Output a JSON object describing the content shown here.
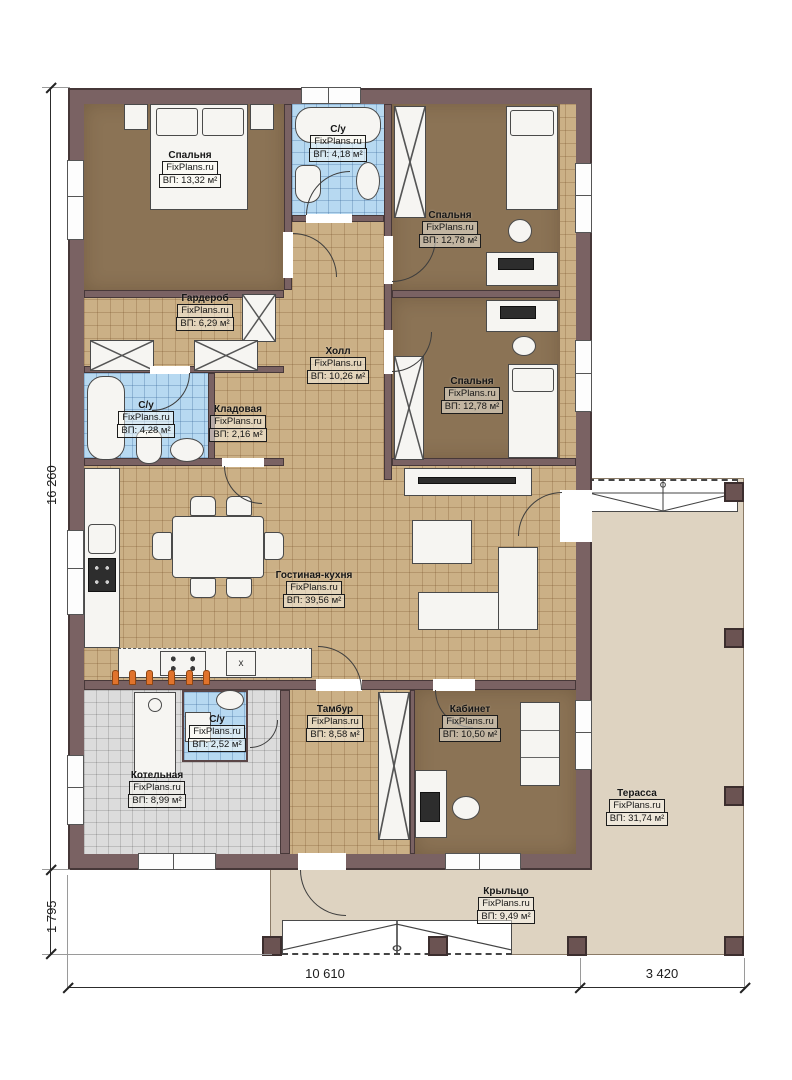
{
  "brand": "FixPlans.ru",
  "rooms": {
    "bedroom1": {
      "name": "Спальня",
      "area": "ВП: 13,32 м²"
    },
    "bath1": {
      "name": "С/у",
      "area": "ВП: 4,18 м²"
    },
    "bedroom2": {
      "name": "Спальня",
      "area": "ВП: 12,78 м²"
    },
    "wardrobe": {
      "name": "Гардероб",
      "area": "ВП: 6,29 м²"
    },
    "hall": {
      "name": "Холл",
      "area": "ВП: 10,26 м²"
    },
    "bedroom3": {
      "name": "Спальня",
      "area": "ВП: 12,78 м²"
    },
    "bath2": {
      "name": "С/у",
      "area": "ВП: 4,28 м²"
    },
    "storage": {
      "name": "Кладовая",
      "area": "ВП: 2,16 м²"
    },
    "living": {
      "name": "Гостиная-кухня",
      "area": "ВП: 39,56 м²"
    },
    "vestibule": {
      "name": "Тамбур",
      "area": "ВП: 8,58 м²"
    },
    "office": {
      "name": "Кабинет",
      "area": "ВП: 10,50 м²"
    },
    "bath3": {
      "name": "С/у",
      "area": "ВП: 2,52 м²"
    },
    "boiler": {
      "name": "Котельная",
      "area": "ВП: 8,99 м²"
    },
    "terrace": {
      "name": "Терасса",
      "area": "ВП: 31,74 м²"
    },
    "porch": {
      "name": "Крыльцо",
      "area": "ВП: 9,49 м²"
    }
  },
  "dimensions": {
    "left_total": "16 260",
    "left_porch": "1 795",
    "bottom_house": "10 610",
    "bottom_terrace": "3 420"
  },
  "kitchen": {
    "appliance_mark": "x"
  },
  "colors": {
    "wall": "#7a6263",
    "floor_tan": "#cbb086",
    "floor_brown": "#8b7355",
    "floor_blue": "#b7d9f1",
    "floor_gray": "#dcdcdc",
    "floor_terrace": "#ded3c1",
    "radiator_orange": "#e0732c"
  }
}
